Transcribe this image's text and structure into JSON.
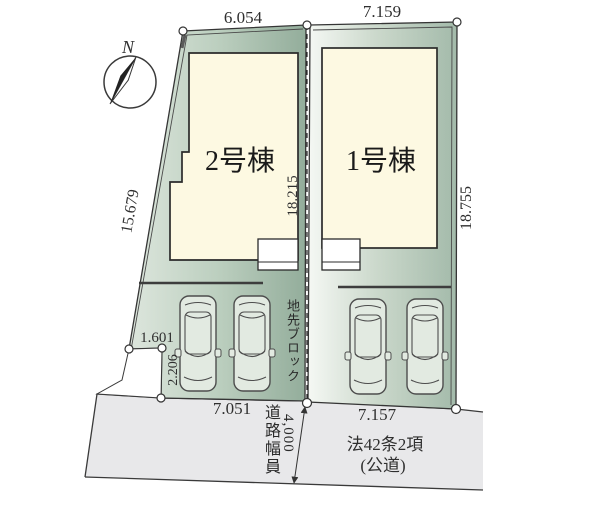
{
  "compass": {
    "north": "N"
  },
  "dimensions": {
    "plot2_top": "6.054",
    "plot1_top": "7.159",
    "plot2_left": "15.679",
    "plot2_right": "18.215",
    "plot1_right": "18.755",
    "cutout_width": "1.601",
    "cutout_depth": "2.206",
    "plot2_bottom": "7.051",
    "plot1_bottom": "7.157"
  },
  "buildings": {
    "plot2_label": "2号棟",
    "plot1_label": "1号棟"
  },
  "labels": {
    "boundary_block": "地先ブロック",
    "road_width_label": "道路幅員",
    "road_width_value": "4,000",
    "road_law": "法42条2項",
    "road_type": "(公道)"
  },
  "colors": {
    "building_cream": "#fdf9e2",
    "road_gray": "#e8e8ea",
    "plot_green_dark": "#9cb5a3",
    "plot_green_light": "#e3ebe2",
    "line_dark": "#333333"
  }
}
